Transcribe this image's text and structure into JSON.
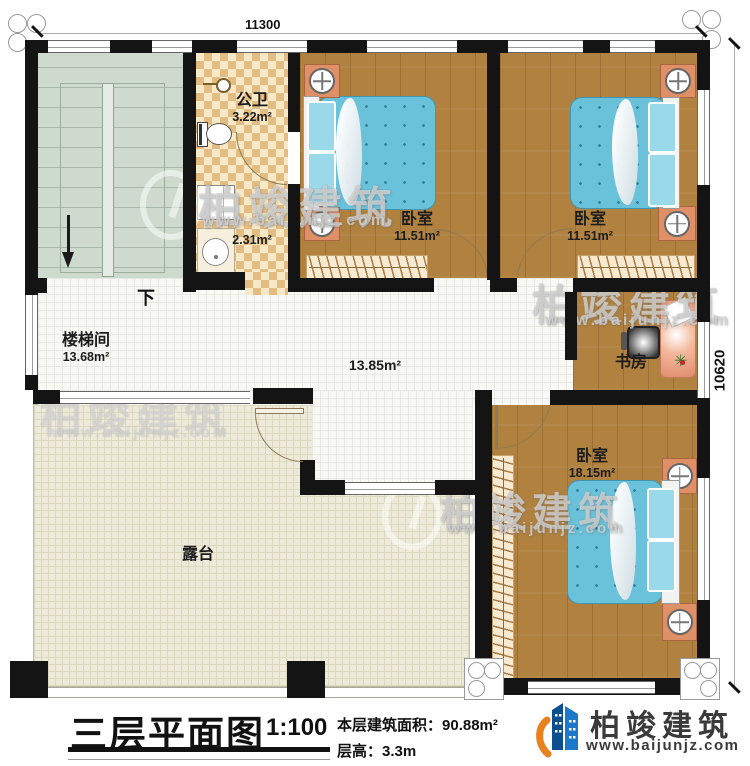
{
  "dimensions": {
    "top": "11300",
    "right": "10620"
  },
  "rooms": {
    "stairwell": {
      "name": "楼梯间",
      "area": "13.68m²",
      "direction": "下"
    },
    "bathroom": {
      "name": "公卫",
      "area": "3.22m²",
      "inner_area": "2.31m²"
    },
    "bedroom1": {
      "name": "卧室",
      "area": "11.51m²"
    },
    "bedroom2": {
      "name": "卧室",
      "area": "11.51m²"
    },
    "hallway": {
      "area": "13.85m²"
    },
    "study": {
      "name": "书房"
    },
    "bedroom3": {
      "name": "卧室",
      "area": "18.15m²"
    },
    "terrace": {
      "name": "露台"
    }
  },
  "title_block": {
    "title": "三层平面图",
    "scale": "1:100",
    "area_label": "本层建筑面积：",
    "area_value": "90.88m²",
    "height_label": "层高：",
    "height_value": "3.3m"
  },
  "brand": {
    "name": "柏竣建筑",
    "website": "www.baijunjz.com"
  },
  "watermark": {
    "name": "柏竣建筑",
    "website": "www.baijunjz.com"
  },
  "colors": {
    "wall": "#141414",
    "wood_floor": "#b0813f",
    "mattress_blue": "#69c2da",
    "checker_tan": "#e3bc83",
    "stairs_green": "#cfdacf",
    "terrace_cream": "#edead9",
    "nightstand_orange": "#e09066",
    "brand_blue": "#1d78c9",
    "brand_orange": "#e8821e"
  }
}
